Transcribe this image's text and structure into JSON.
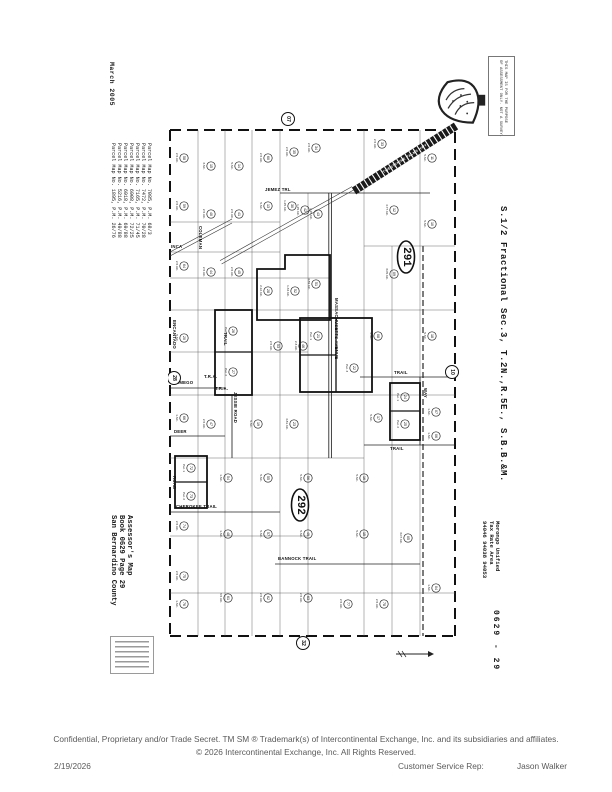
{
  "page": {
    "scan_date": "March 2005",
    "footer": {
      "line1": "Confidential, Proprietary and/or Trade Secret.  TM SM  ® Trademark(s) of Intercontinental Exchange, Inc. and its subsidiaries and affiliates.",
      "line2": "© 2026 Intercontinental Exchange, Inc. All Rights Reserved.",
      "date": "2/19/2026",
      "csr_label": "Customer Service Rep:",
      "csr_name": "Jason Walker"
    }
  },
  "left_margin": {
    "parcel_maps": [
      "Parcel Map No. 7085, P.M. 68/3",
      "Parcel Map No. 7472, P.M. 70/28",
      "Parcel Map No. 7165, P.M. 71/45",
      "Parcel Map No. 6908, P.M. 72/25",
      "Parcel Map No. 6918, P.M. 69/88",
      "Parcel Map No. 5216, P.M. 49/88",
      "Parcel Map No. 1895, P.M. 26/76"
    ],
    "assessor_block": [
      "Assessor's Map",
      "Book 0629 Page 29",
      "San Bernardino County"
    ]
  },
  "right_margin": {
    "section_title": "S.1/2 Fractional Sec.3, T.2N.,R.5E., S.B.B.&M.",
    "tax_rate": [
      "Morongo Unified",
      "Tax Rate Area",
      "94046 94038 94053"
    ],
    "page_code": "0629 - 29",
    "disclaimer": [
      "THIS MAP IS FOR THE PURPOSE",
      "OF ASSESSMENT ONLY. NOT A SURVEY."
    ]
  },
  "map": {
    "highway": {
      "label": "TWENTYNINE PALMS HWY"
    },
    "streets": [
      {
        "label": "JEMEZ TRL",
        "x": 97,
        "y": 85
      },
      {
        "label": "TRAIL",
        "x": 226,
        "y": 268
      },
      {
        "label": "TRAIL",
        "x": 222,
        "y": 344
      },
      {
        "label": "WAMEGO",
        "x": 4,
        "y": 278
      },
      {
        "label": "DEER",
        "x": 6,
        "y": 327
      },
      {
        "label": "CHEROKEE TRAIL",
        "x": 8,
        "y": 402
      },
      {
        "label": "BANNOCK  TRAIL",
        "x": 110,
        "y": 454
      },
      {
        "label": "INCA",
        "x": 3,
        "y": 142
      },
      {
        "label": "T.R.A.",
        "x": 36,
        "y": 272
      },
      {
        "label": "T.R.A.",
        "x": 47,
        "y": 284
      },
      {
        "label": "MASSACHUSETTS AVENUE",
        "x": 167,
        "y": 192,
        "rot": 1
      },
      {
        "label": "ENCANTADO",
        "x": 5,
        "y": 214,
        "rot": 1
      },
      {
        "label": "COLEMAN",
        "x": 31,
        "y": 120,
        "rot": 1
      },
      {
        "label": "JESSIE ROAD",
        "x": 66,
        "y": 286,
        "rot": 1
      },
      {
        "label": "TRAIL",
        "x": 56,
        "y": 226,
        "rot": 1
      },
      {
        "label": "ROAD",
        "x": 5,
        "y": 370,
        "rot": 1
      },
      {
        "label": "WAY",
        "x": 256,
        "y": 282,
        "rot": 1
      }
    ],
    "edge_circles": [
      {
        "label": "07",
        "x": 120,
        "y": 13
      },
      {
        "label": "28",
        "x": 6,
        "y": 272
      },
      {
        "label": "10",
        "x": 284,
        "y": 266
      },
      {
        "label": "32",
        "x": 135,
        "y": 537
      }
    ],
    "ellipses": [
      {
        "label": "291",
        "x": 238,
        "y": 151
      },
      {
        "label": "292",
        "x": 132,
        "y": 399
      }
    ],
    "parcels": [
      {
        "x": 16,
        "y": 52,
        "n": "58",
        "ac": "2.5 AC."
      },
      {
        "x": 43,
        "y": 60,
        "n": "15",
        "ac": "3 AC."
      },
      {
        "x": 71,
        "y": 60,
        "n": "14",
        "ac": "5 AC."
      },
      {
        "x": 100,
        "y": 52,
        "n": "60",
        "ac": "2.5 AC."
      },
      {
        "x": 126,
        "y": 46,
        "n": "35",
        "ac": "2.5 AC."
      },
      {
        "x": 148,
        "y": 42,
        "n": "34",
        "ac": "2.5 AC."
      },
      {
        "x": 214,
        "y": 38,
        "n": "33",
        "ac": "2.5 AC."
      },
      {
        "x": 264,
        "y": 52,
        "n": "11",
        "ac": "5 AC."
      },
      {
        "x": 16,
        "y": 100,
        "n": "59",
        "ac": "2.5 AC."
      },
      {
        "x": 43,
        "y": 108,
        "n": "40",
        "ac": "2.5 AC."
      },
      {
        "x": 71,
        "y": 108,
        "n": "41",
        "ac": "2.5 AC."
      },
      {
        "x": 100,
        "y": 100,
        "n": "13",
        "ac": "5 AC."
      },
      {
        "x": 124,
        "y": 100,
        "n": "30",
        "ac": "1.25 AC."
      },
      {
        "x": 137,
        "y": 104,
        "n": "42",
        "ac": "1.25 AC."
      },
      {
        "x": 150,
        "y": 108,
        "n": "43",
        "ac": "1.25 AC."
      },
      {
        "x": 226,
        "y": 104,
        "n": "12",
        "ac": "4.77 AC."
      },
      {
        "x": 264,
        "y": 118,
        "n": "10",
        "ac": "5 AC."
      },
      {
        "x": 16,
        "y": 160,
        "n": "64",
        "ac": "2.5 AC."
      },
      {
        "x": 43,
        "y": 166,
        "n": "44",
        "ac": "2.5 AC."
      },
      {
        "x": 71,
        "y": 166,
        "n": "45",
        "ac": "2.5 AC."
      },
      {
        "x": 100,
        "y": 185,
        "n": "28",
        "ac": "2.12 AC."
      },
      {
        "x": 127,
        "y": 185,
        "n": "52",
        "ac": "1.34 AC."
      },
      {
        "x": 148,
        "y": 178,
        "n": "51",
        "ac": "4.89 AC."
      },
      {
        "x": 226,
        "y": 168,
        "n": "09",
        "ac": "3.05 AC."
      },
      {
        "x": 16,
        "y": 232,
        "n": "20",
        "ac": "5 AC."
      },
      {
        "x": 65,
        "y": 225,
        "n": "26",
        "ac": "Par. 1"
      },
      {
        "x": 65,
        "y": 266,
        "n": "27",
        "ac": "Par. 2"
      },
      {
        "x": 110,
        "y": 240,
        "n": "53",
        "ac": "2.5 AC."
      },
      {
        "x": 135,
        "y": 240,
        "n": "46",
        "ac": "2.3 AC."
      },
      {
        "x": 150,
        "y": 230,
        "n": "21",
        "ac": "Par. 1"
      },
      {
        "x": 186,
        "y": 262,
        "n": "22",
        "ac": "Par. 3"
      },
      {
        "x": 210,
        "y": 230,
        "n": "08",
        "ac": "5 AC."
      },
      {
        "x": 264,
        "y": 230,
        "n": "18",
        "ac": "5 AC."
      },
      {
        "x": 16,
        "y": 312,
        "n": "66",
        "ac": "1 AC."
      },
      {
        "x": 43,
        "y": 318,
        "n": "47",
        "ac": "2.5 AC."
      },
      {
        "x": 90,
        "y": 318,
        "n": "19",
        "ac": "5 AC."
      },
      {
        "x": 126,
        "y": 318,
        "n": "23",
        "ac": "4.81 AC."
      },
      {
        "x": 210,
        "y": 312,
        "n": "17",
        "ac": "5 AC."
      },
      {
        "x": 237,
        "y": 291,
        "n": "24",
        "ac": "Par. 1"
      },
      {
        "x": 237,
        "y": 318,
        "n": "25",
        "ac": "Par. 2"
      },
      {
        "x": 268,
        "y": 306,
        "n": "07",
        "ac": "1 AC."
      },
      {
        "x": 268,
        "y": 330,
        "n": "06",
        "ac": "1 AC."
      },
      {
        "x": 23,
        "y": 362,
        "n": "72",
        "ac": "Par. 1"
      },
      {
        "x": 23,
        "y": 390,
        "n": "73",
        "ac": "Par. 2"
      },
      {
        "x": 60,
        "y": 372,
        "n": "54",
        "ac": "1 AC."
      },
      {
        "x": 100,
        "y": 372,
        "n": "55",
        "ac": "5 AC."
      },
      {
        "x": 140,
        "y": 372,
        "n": "56",
        "ac": "5 AC."
      },
      {
        "x": 196,
        "y": 372,
        "n": "16",
        "ac": "5 AC."
      },
      {
        "x": 16,
        "y": 420,
        "n": "74",
        "ac": "2.5 AC."
      },
      {
        "x": 60,
        "y": 428,
        "n": "48",
        "ac": "1 AC."
      },
      {
        "x": 100,
        "y": 428,
        "n": "57",
        "ac": "5 AC."
      },
      {
        "x": 140,
        "y": 428,
        "n": "49",
        "ac": "5 AC."
      },
      {
        "x": 196,
        "y": 428,
        "n": "15",
        "ac": "5 AC."
      },
      {
        "x": 240,
        "y": 432,
        "n": "05",
        "ac": "3.07 AC."
      },
      {
        "x": 16,
        "y": 470,
        "n": "75",
        "ac": "2.5 AC."
      },
      {
        "x": 16,
        "y": 498,
        "n": "76",
        "ac": "1 AC."
      },
      {
        "x": 60,
        "y": 492,
        "n": "61",
        "ac": "3.5 AC."
      },
      {
        "x": 100,
        "y": 492,
        "n": "62",
        "ac": "2.5 AC."
      },
      {
        "x": 140,
        "y": 492,
        "n": "63",
        "ac": "2.5 AC."
      },
      {
        "x": 180,
        "y": 498,
        "n": "77",
        "ac": "2.5 AC."
      },
      {
        "x": 216,
        "y": 498,
        "n": "78",
        "ac": "2.5 AC."
      },
      {
        "x": 268,
        "y": 482,
        "n": "04",
        "ac": "1 AC."
      }
    ]
  }
}
